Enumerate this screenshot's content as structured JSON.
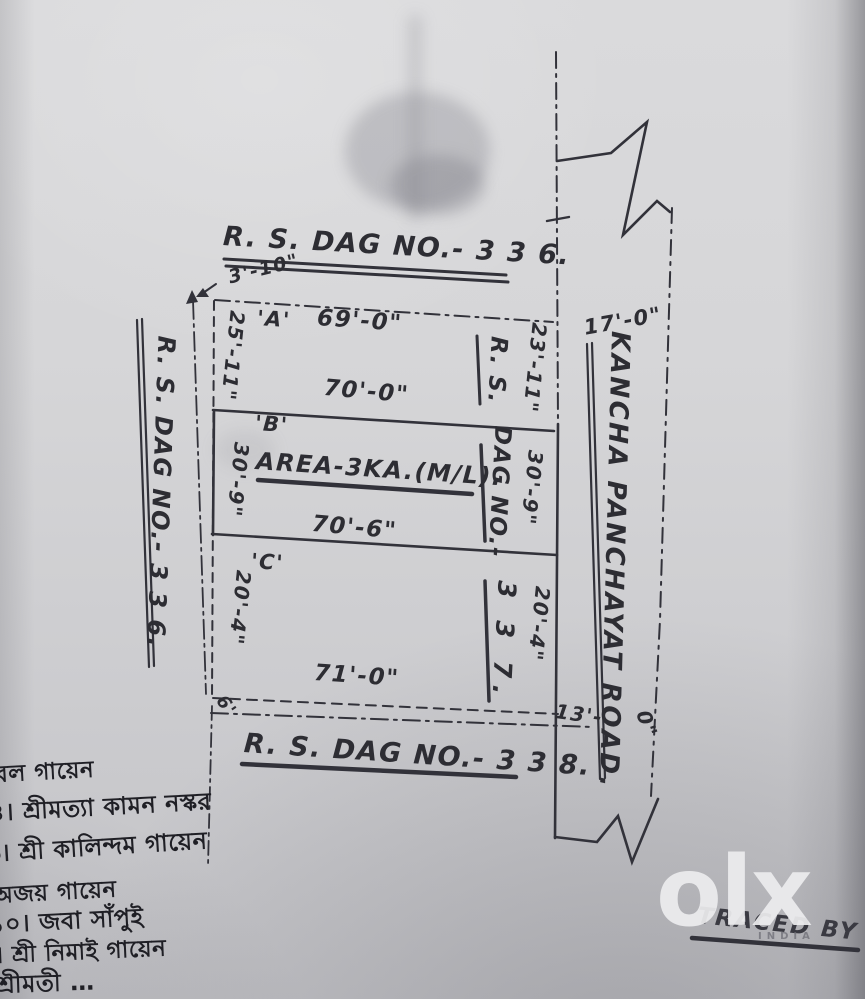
{
  "map": {
    "boundaries": {
      "north_plot_label": "R. S. DAG NO.- 3 3 6.",
      "west_plot_label": "R. S. DAG NO.- 3 3 6.",
      "south_plot_label": "R. S. DAG NO.- 3 3 8.",
      "northwest_corner_offset": "3'-10\"",
      "southwest_corner_offset": "6'"
    },
    "parcel_dag_label": {
      "line1": "R. S.",
      "line2": "DAG NO.-",
      "line3": "3 3 7."
    },
    "plots": {
      "a": {
        "name": "'A'",
        "top_width": "69'-0\"",
        "bottom_width": "70'-0\"",
        "west_side": "25'-11\"",
        "east_side": "23'-11\""
      },
      "b": {
        "name": "'B'",
        "area_note": "AREA-3KA.(M/L).",
        "bottom_width": "70'-6\"",
        "west_side": "30'-9\"",
        "east_side": "30'-9\""
      },
      "c": {
        "name": "'C'",
        "bottom_width": "71'-0\"",
        "west_side": "20'-4\"",
        "east_side": "20'-4\""
      }
    },
    "road": {
      "name": "KANCHA PANCHAYAT ROAD.",
      "width_north": "17'-0\"",
      "width_south_part1": "13'-",
      "width_south_part2": "0\""
    }
  },
  "handwritten_notes": {
    "lines": [
      "বল গায়েন",
      "৪। শ্রীমত্যা কামন নস্কর",
      "৬। শ্রী কালিন্দম গায়েন",
      "অজয় গায়েন",
      "১০। জবা সাঁপুই",
      "। শ্রী নিমাই গায়েন",
      "শ্রীমতী …"
    ]
  },
  "footer": {
    "traced_by": "TRACED BY"
  },
  "watermark": {
    "brand": "olx",
    "sub": "INDIA"
  },
  "colors": {
    "ink": "#32323a",
    "paper": "#d4d4d7",
    "watermark": "#ececee"
  }
}
